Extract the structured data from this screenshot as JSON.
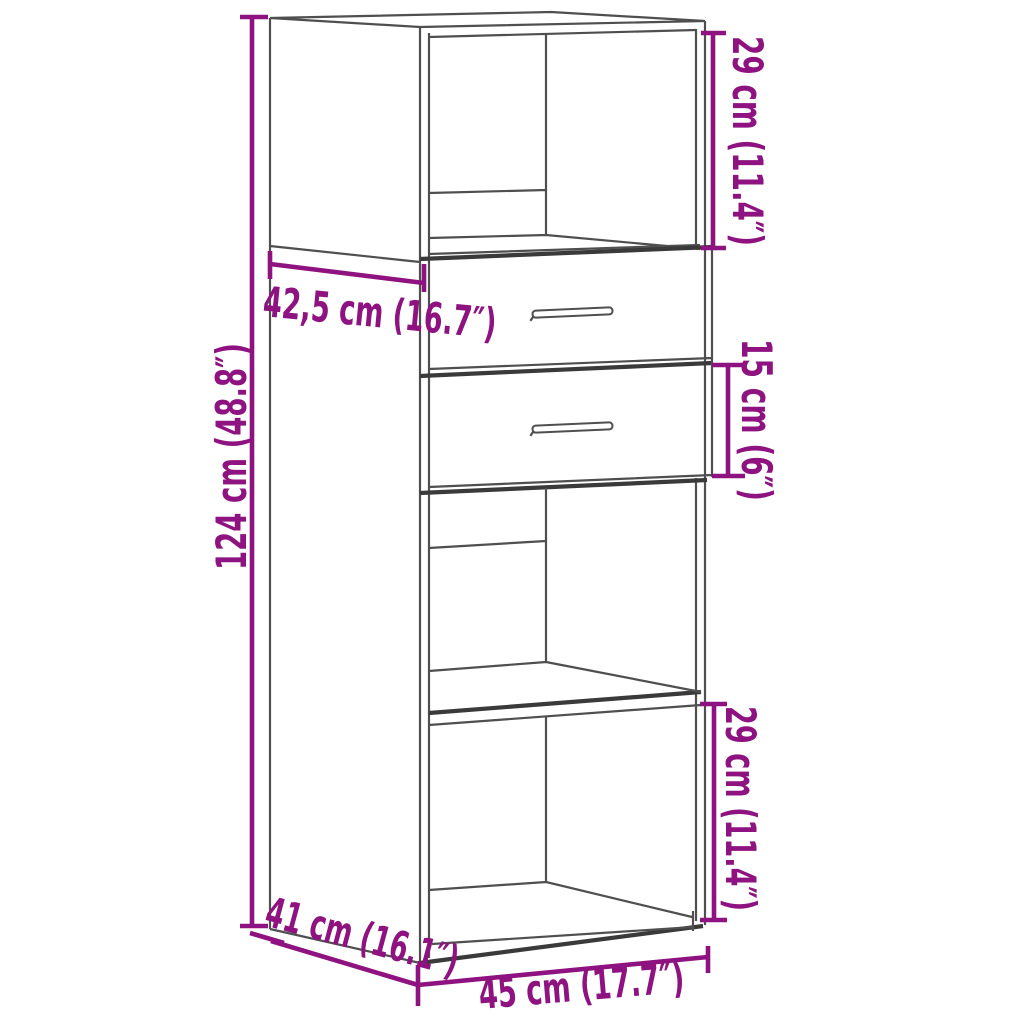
{
  "diagram": {
    "dimension_labels": {
      "top_compartment_height": "29 cm (11.4″)",
      "top_depth": "42,5 cm (16.7″)",
      "drawer_height": "15 cm (6″)",
      "total_height": "124 cm (48.8″)",
      "bottom_compartment_height": "29 cm (11.4″)",
      "depth": "41 cm (16.1″)",
      "width": "45 cm (17.7″)"
    },
    "measurements": {
      "total_height_cm": "124",
      "total_height_in": "48.8",
      "width_cm": "45",
      "width_in": "17.7",
      "depth_cm": "41",
      "depth_in": "16.1",
      "top_depth_cm": "42,5",
      "top_depth_in": "16.7",
      "top_compartment_height_cm": "29",
      "top_compartment_height_in": "11.4",
      "drawer_height_cm": "15",
      "drawer_height_in": "6",
      "bottom_compartment_height_cm": "29",
      "bottom_compartment_height_in": "11.4"
    },
    "colors": {
      "dimension_annotation": "#8E1280",
      "drawing_line": "#4F4F4F",
      "heavy_line": "#3A3A3A",
      "background": "#FFFFFF"
    }
  }
}
